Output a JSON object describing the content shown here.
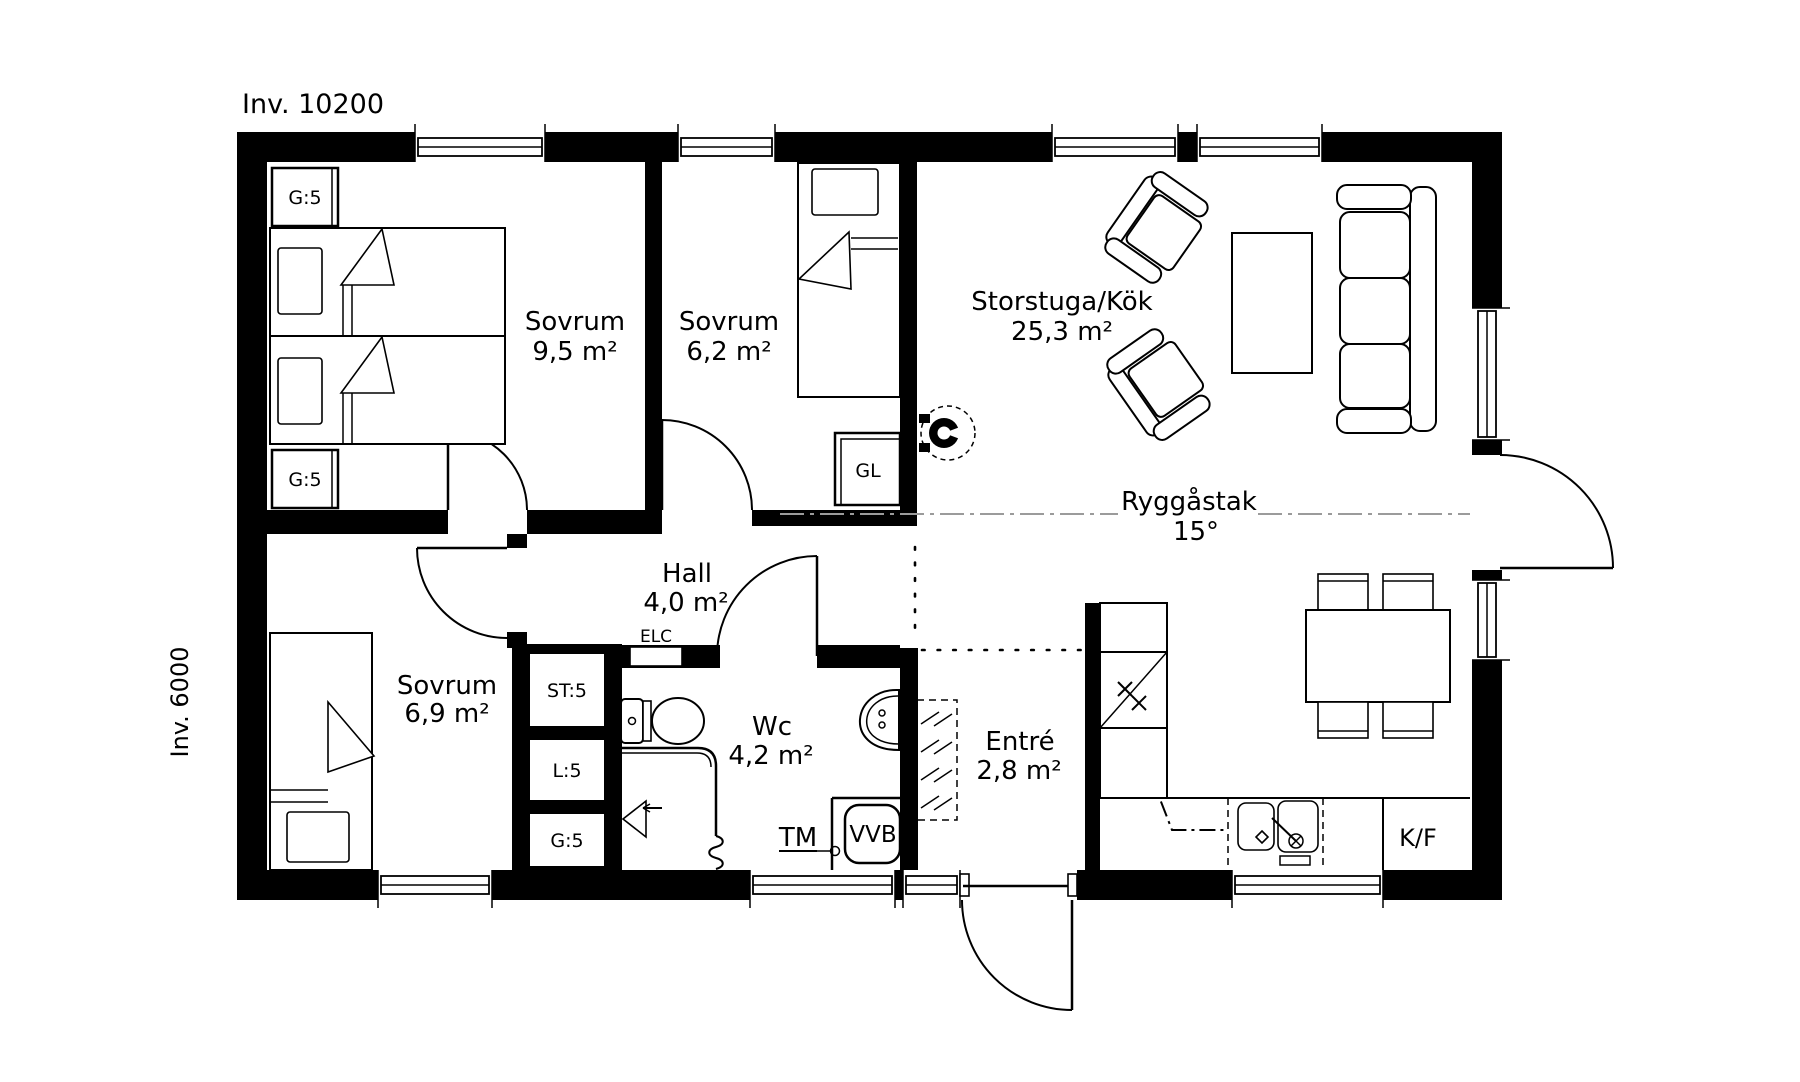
{
  "title": "Inv. 10200",
  "side_dimension_label": "Inv. 6000",
  "rooms": {
    "bedroom1": {
      "name": "Sovrum",
      "area": "9,5 m²"
    },
    "bedroom2": {
      "name": "Sovrum",
      "area": "6,2 m²"
    },
    "bedroom3": {
      "name": "Sovrum",
      "area": "6,9 m²"
    },
    "living_kitchen": {
      "name": "Storstuga/Kök",
      "area": "25,3 m²"
    },
    "hall": {
      "name": "Hall",
      "area": "4,0 m²"
    },
    "wc": {
      "name": "Wc",
      "area": "4,2 m²"
    },
    "entrance": {
      "name": "Entré",
      "area": "2,8 m²"
    }
  },
  "roof": {
    "label": "Ryggåstak",
    "pitch": "15°"
  },
  "fixtures": {
    "wardrobe_top": "G:5",
    "wardrobe_bottom": "G:5",
    "closet_st": "ST:5",
    "closet_l": "L:5",
    "closet_g": "G:5",
    "cabinet_gl": "GL",
    "electrical_cabinet": "ELC",
    "washing_machine": "TM",
    "water_heater": "VVB",
    "fridge_freezer": "K/F"
  },
  "colors": {
    "line": "#000000",
    "background": "#ffffff",
    "ridge_line": "#9b9b9b"
  }
}
